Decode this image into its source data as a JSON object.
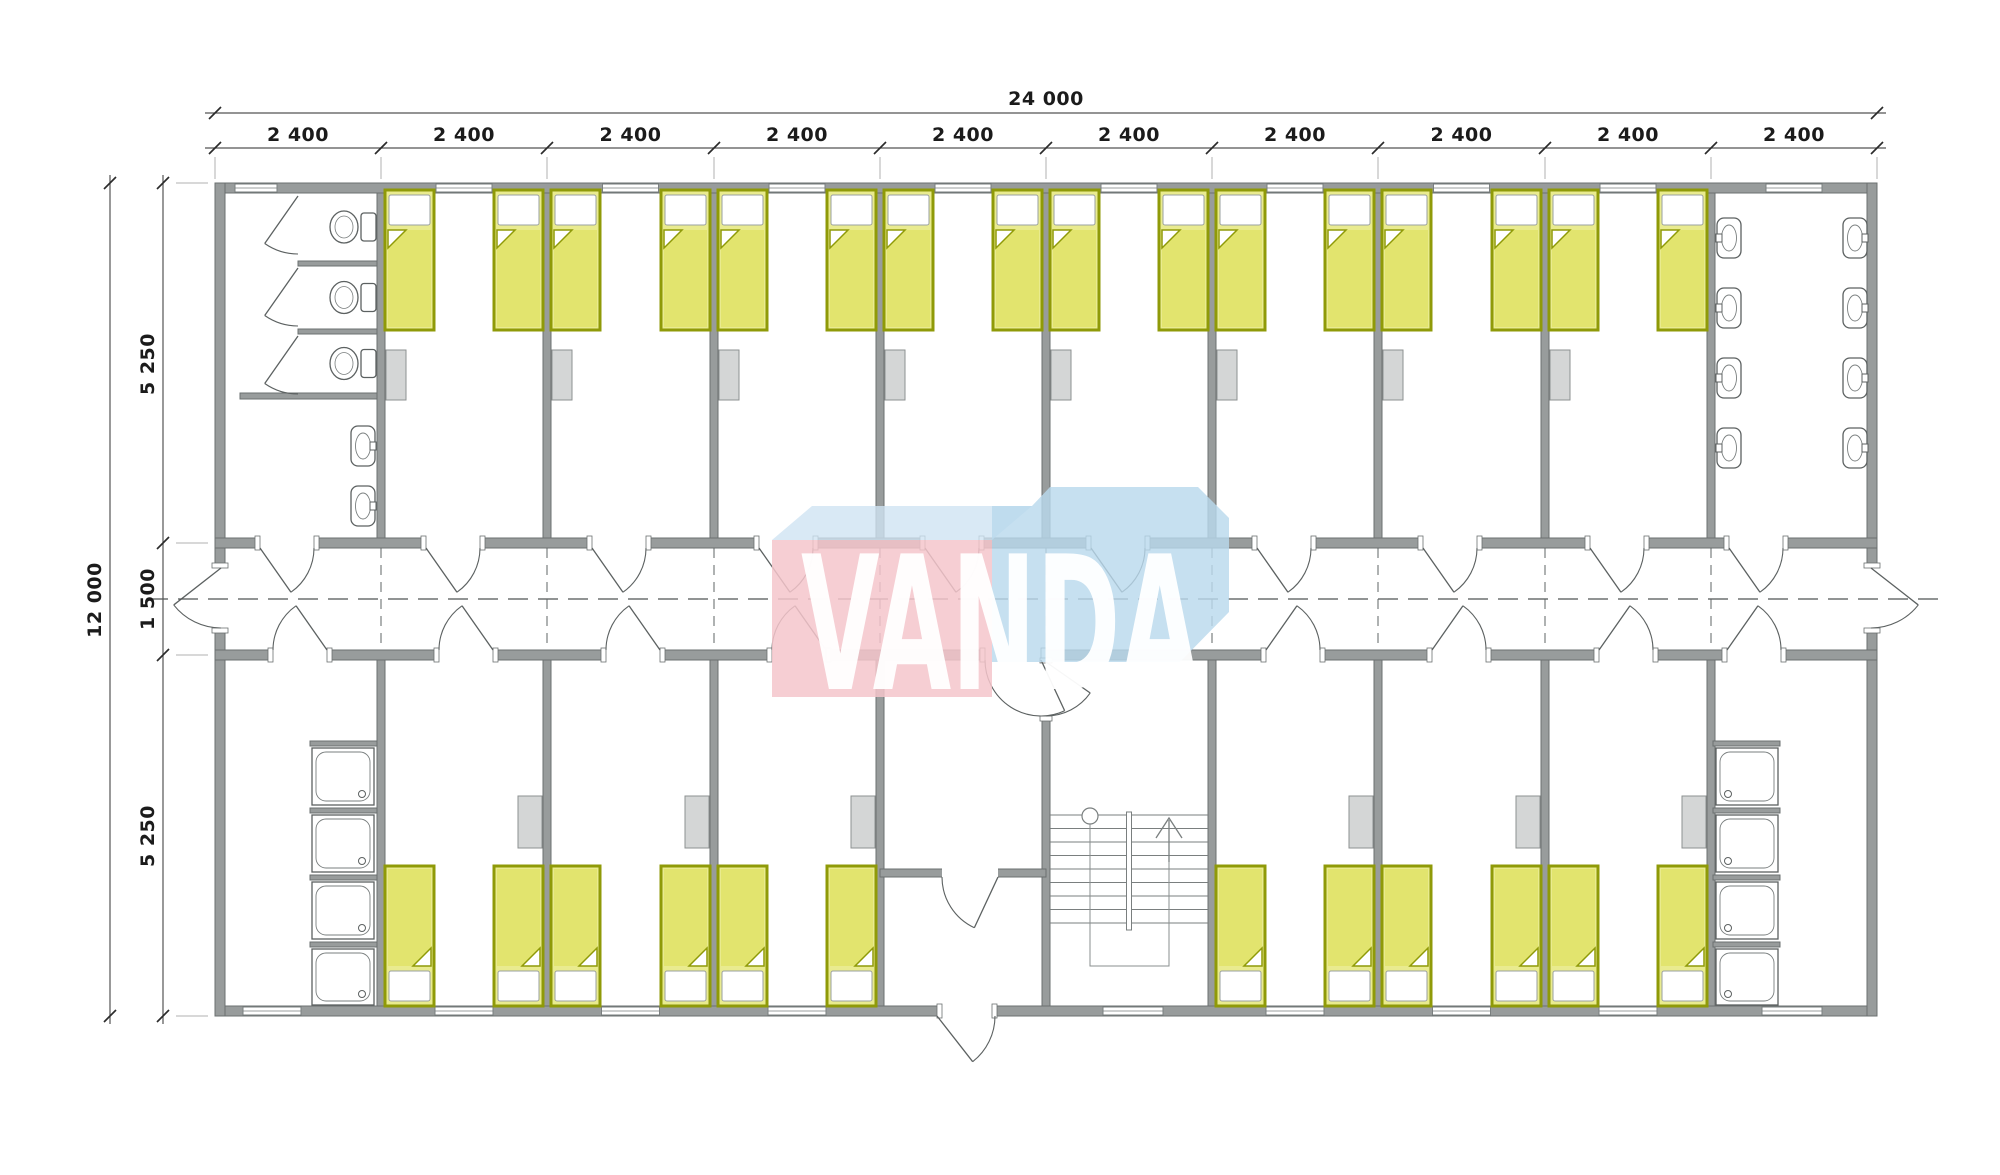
{
  "page": {
    "title": "Modular dormitory floor plan",
    "background": "#ffffff"
  },
  "dimensions": {
    "top_total": "24 000",
    "top_segments": [
      "2 400",
      "2 400",
      "2 400",
      "2 400",
      "2 400",
      "2 400",
      "2 400",
      "2 400",
      "2 400",
      "2 400"
    ],
    "left_total": "12 000",
    "left_segments": [
      "5 250",
      "1 500",
      "5 250"
    ]
  },
  "watermark": {
    "text": "VANDA",
    "pink": "#f5c5cb",
    "blue": "#b9d9ed",
    "roof": "#d0e4f2",
    "text_color": "#ffffff"
  },
  "building": {
    "modules": 10,
    "module_width_mm": 2400,
    "total_width_mm": 24000,
    "total_depth_mm": 12000,
    "depth_zones_mm": [
      5250,
      1500,
      5250
    ],
    "top_row_rooms": [
      "wc-room",
      "bedroom",
      "bedroom",
      "bedroom",
      "bedroom",
      "bedroom",
      "bedroom",
      "bedroom",
      "bedroom",
      "washroom"
    ],
    "bottom_row_rooms": [
      "shower-room",
      "bedroom",
      "bedroom",
      "bedroom",
      "entrance-vestibule",
      "stairwell",
      "bedroom",
      "bedroom",
      "bedroom",
      "shower-room"
    ],
    "fixture_counts": {
      "beds": 28,
      "toilets": 3,
      "wash_basins": 10,
      "showers": 8,
      "lockers": 14,
      "staircases": 1
    }
  },
  "colors": {
    "wall_fill": "#989c9c",
    "wall_stroke": "#6b7070",
    "line": "#5c6161",
    "thin_line": "#7a7f7f",
    "bed_fill": "#e9eb8f",
    "bed_blanket": "#e2e46e",
    "bed_frame": "#8f9a08",
    "locker_fill": "#d4d6d6",
    "locker_stroke": "#8d9191",
    "dim_line": "#555555",
    "dim_text": "#1b1b1b"
  }
}
